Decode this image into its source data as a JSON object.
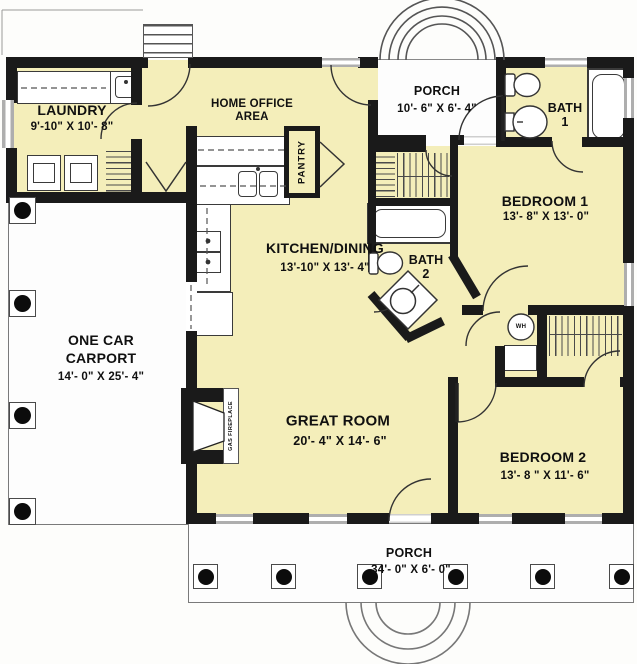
{
  "title": "House floor plan",
  "colors": {
    "interior_fill": "#f4eeba",
    "wall": "#1a1a1a",
    "porch_fill": "#fdfdfd",
    "window_gray": "#aeaeae",
    "outline_gray": "#7a7a7a"
  },
  "rooms": {
    "laundry": {
      "name": "LAUNDRY",
      "dims": "9'-10\" X 10'- 8\""
    },
    "home_office": {
      "line1": "HOME OFFICE",
      "line2": "AREA"
    },
    "porch_top": {
      "name": "PORCH",
      "dims": "10'- 6\" X 6'- 4\""
    },
    "bath_1": {
      "name": "BATH",
      "number": "1"
    },
    "bedroom_1": {
      "name": "BEDROOM 1",
      "dims": "13'- 8\" X 13'- 0\""
    },
    "kitchen_dining": {
      "name": "KITCHEN/DINING",
      "dims": "13'-10\" X 13'- 4\""
    },
    "bath_2": {
      "name": "BATH",
      "number": "2"
    },
    "carport": {
      "line1": "ONE CAR",
      "line2": "CARPORT",
      "dims": "14'- 0\" X 25'- 4\""
    },
    "great_room": {
      "name": "GREAT ROOM",
      "dims": "20'- 4\" X 14'- 6\""
    },
    "bedroom_2": {
      "name": "BEDROOM 2",
      "dims": "13'- 8 \" X 11'- 6\""
    },
    "porch_bottom": {
      "name": "PORCH",
      "dims": "34'- 0\" X 6'- 0\""
    },
    "pantry": {
      "name": "PANTRY"
    },
    "fireplace": {
      "label": "GAS FIREPLACE"
    },
    "water_heater": {
      "label": "WH"
    }
  },
  "icons": [
    "washer-icon",
    "dryer-icon",
    "laundry-sink-icon",
    "kitchen-sink-icon",
    "range-icon",
    "refrigerator-icon",
    "bathtub-icon",
    "toilet-icon",
    "pedestal-sink-icon",
    "corner-shower-icon",
    "water-heater-icon",
    "gas-fireplace-icon",
    "clothes-rod-icon",
    "shelf-closet-icon",
    "porch-column-icon",
    "door-swing-icon",
    "window-icon",
    "arched-entry-icon",
    "steps-icon"
  ]
}
